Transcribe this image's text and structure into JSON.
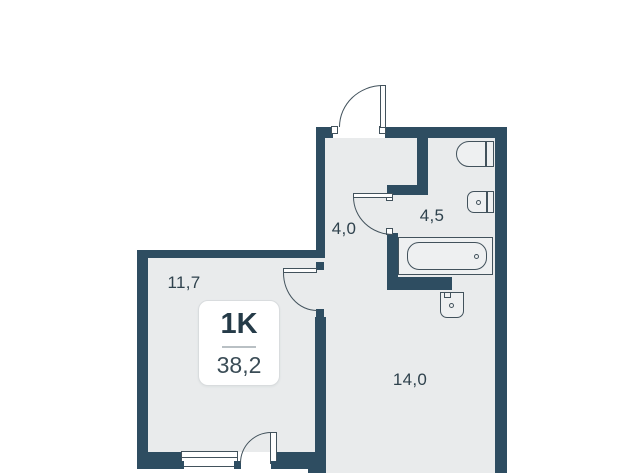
{
  "plan": {
    "badge": {
      "type": "1K",
      "total_area": "38,2"
    },
    "rooms": {
      "hallway": {
        "area": "4,0"
      },
      "bathroom": {
        "area": "4,5"
      },
      "living": {
        "area": "11,7"
      },
      "kitchen": {
        "area": "14,0"
      }
    },
    "fixtures": [
      "toilet",
      "sink",
      "bathtub",
      "washbasin",
      "window",
      "entrance-door",
      "bathroom-door",
      "room-door",
      "balcony-door"
    ],
    "colors": {
      "wall": "#2e4d61",
      "floor": "#e9ebec",
      "fixture": "#eef0f1",
      "stroke": "#42525c",
      "text": "#2f424d",
      "background": "#ffffff"
    }
  }
}
